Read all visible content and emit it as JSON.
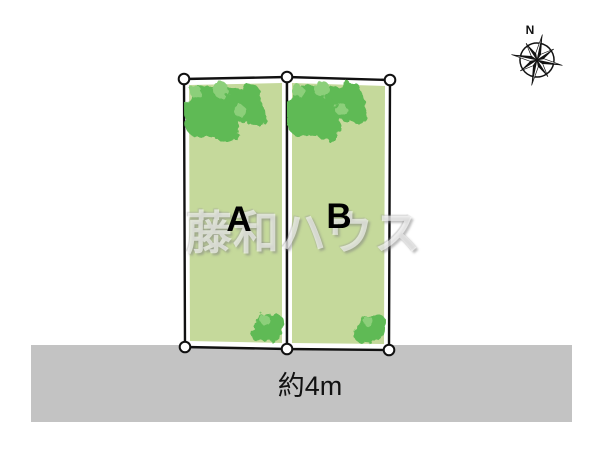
{
  "diagram": {
    "type": "real-estate-lot-layout",
    "compass": {
      "north_label": "N"
    },
    "plots": [
      {
        "label": "A"
      },
      {
        "label": "B"
      }
    ],
    "road": {
      "width_label": "約4m"
    },
    "watermark": {
      "text": "藤和ハウス"
    }
  },
  "colors": {
    "background": "#ffffff",
    "plot_fill": "#c5d99b",
    "tree_green": "#5fba55",
    "tree_green_light": "#8ccf7a",
    "road_gray": "#c3c3c3",
    "outline": "#111111"
  }
}
